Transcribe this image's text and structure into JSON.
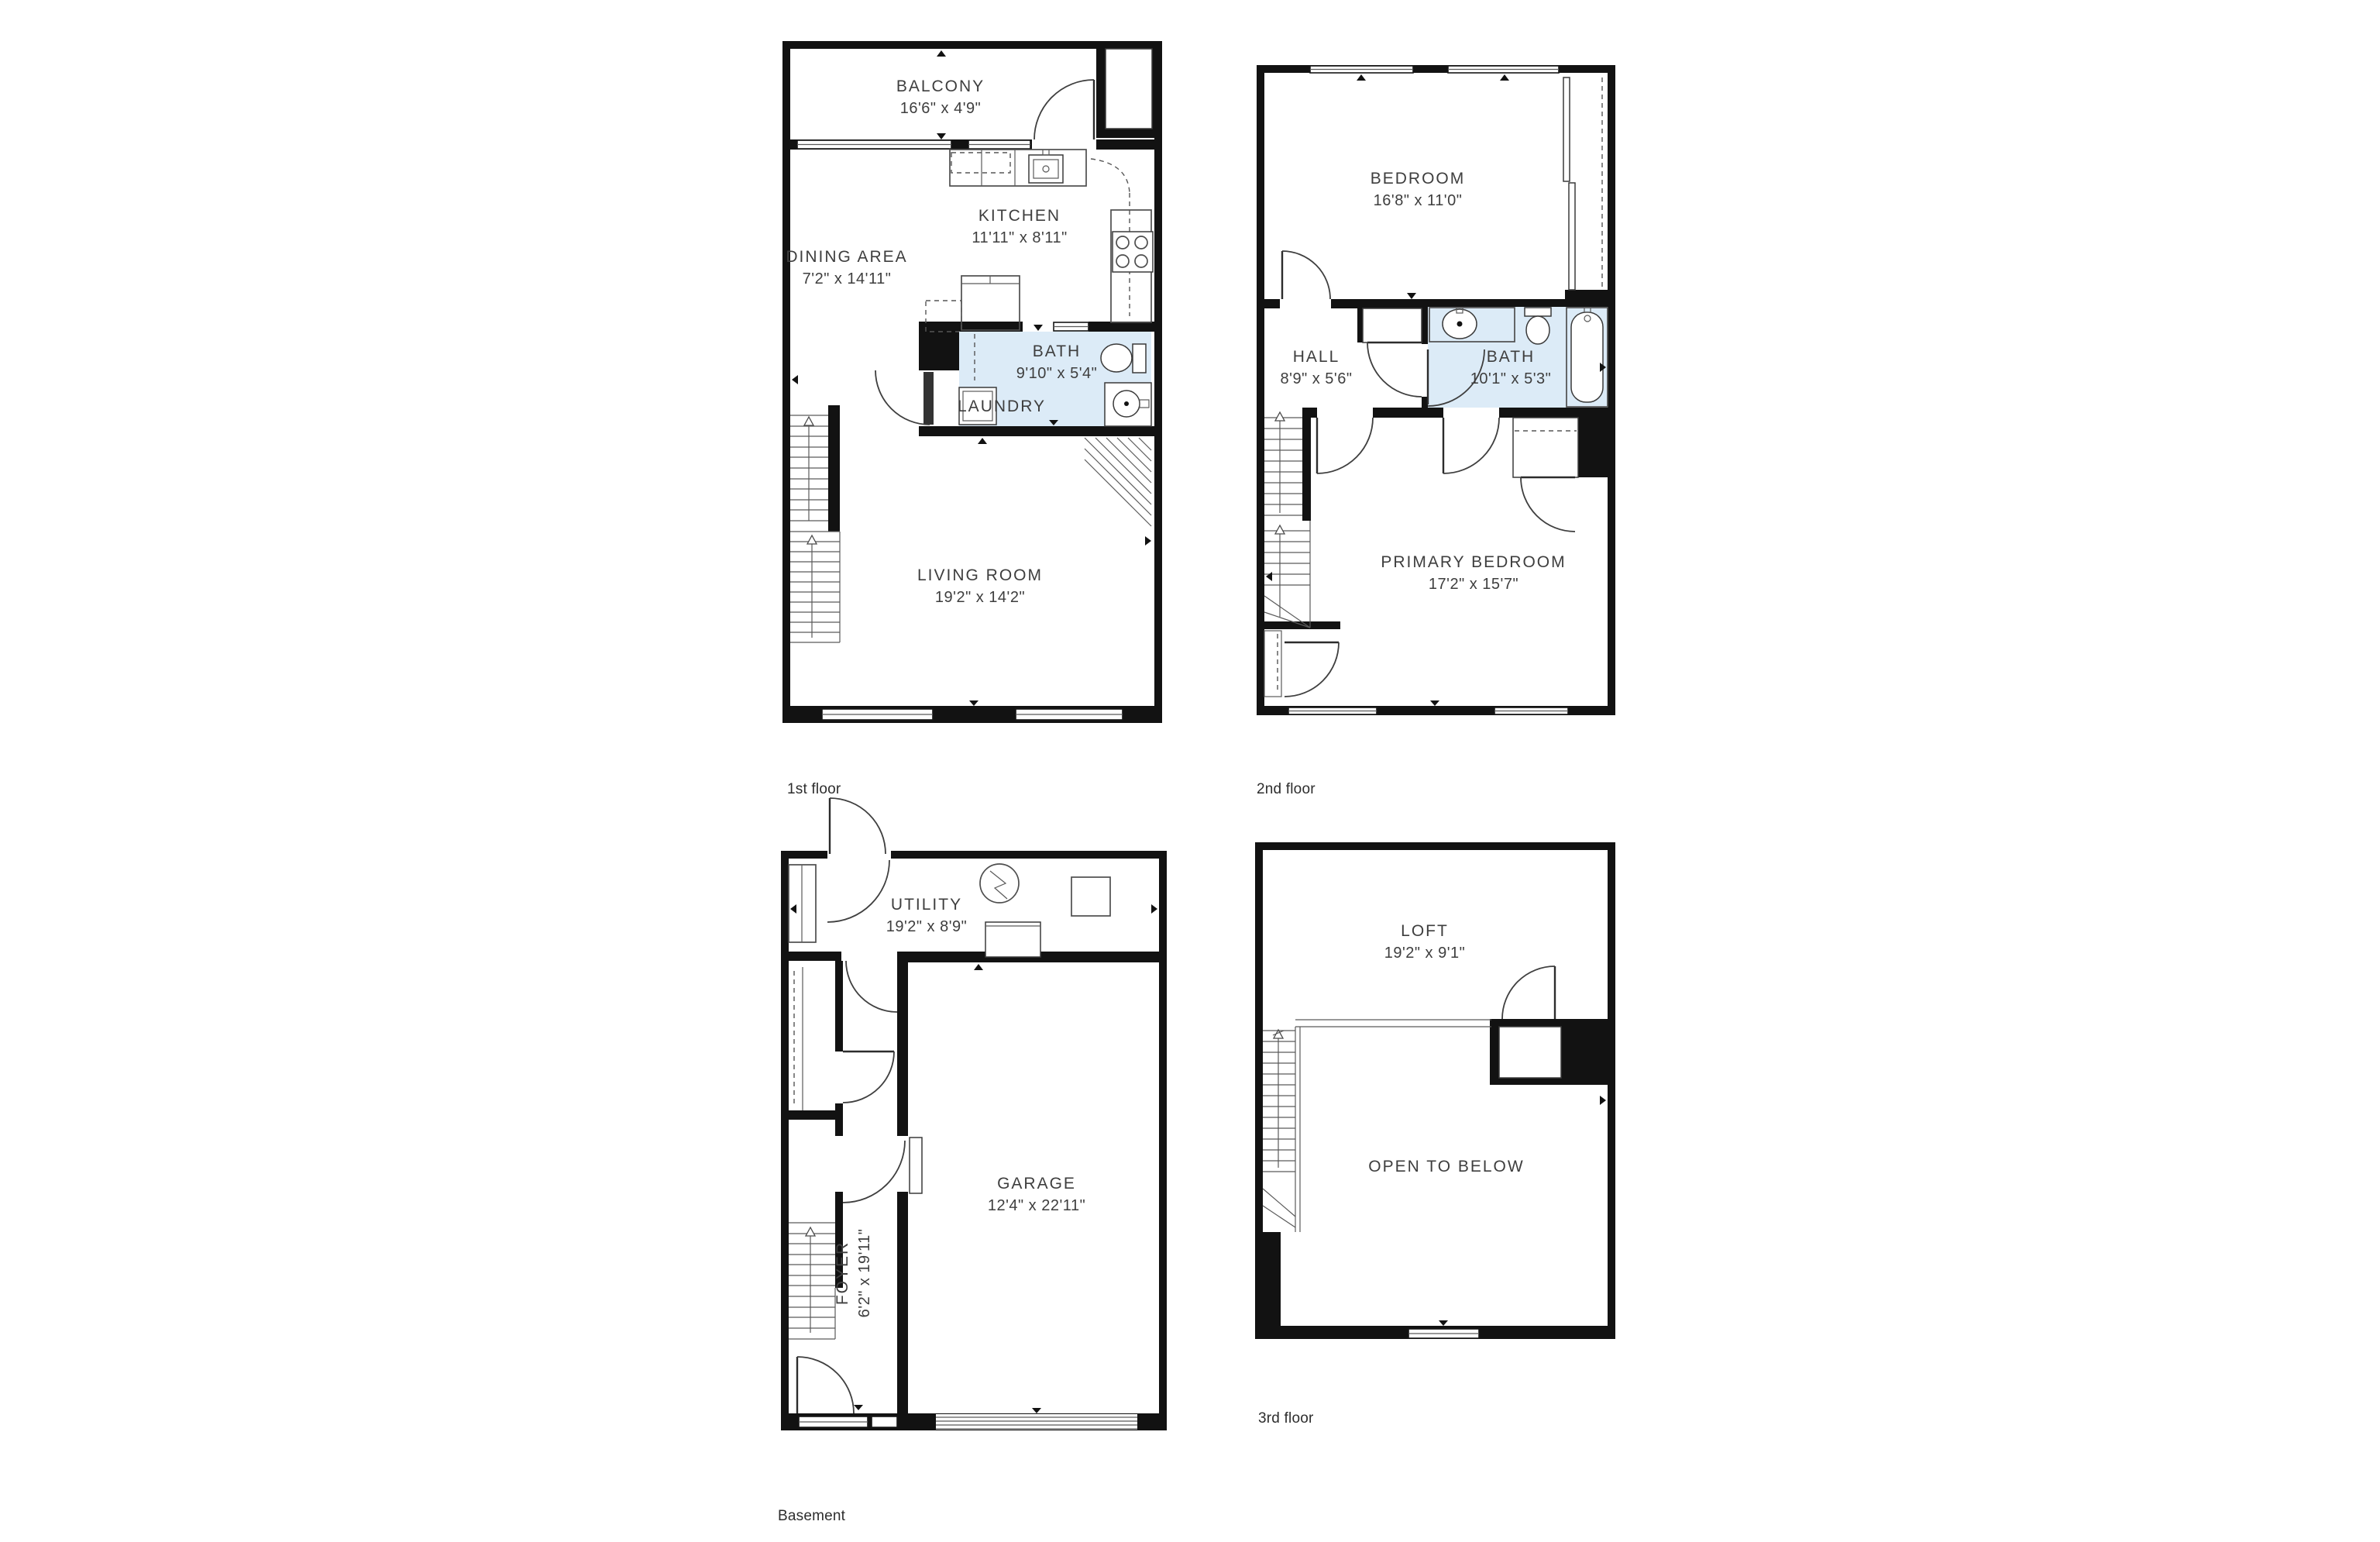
{
  "colors": {
    "wall": "#121212",
    "bath_fill": "#dcebf7",
    "fixture_line": "#4e4e4e",
    "text": "#3e3e3e"
  },
  "floors": {
    "floor1": {
      "label": "1st floor",
      "rooms": {
        "balcony": {
          "name": "BALCONY",
          "dims": "16'6\" x 4'9\""
        },
        "kitchen": {
          "name": "KITCHEN",
          "dims": "11'11\" x 8'11\""
        },
        "dining": {
          "name": "DINING AREA",
          "dims": "7'2\" x 14'11\""
        },
        "bath": {
          "name": "BATH",
          "dims": "9'10\" x 5'4\""
        },
        "laundry": {
          "name": "LAUNDRY"
        },
        "living": {
          "name": "LIVING ROOM",
          "dims": "19'2\" x 14'2\""
        }
      }
    },
    "floor2": {
      "label": "2nd floor",
      "rooms": {
        "bedroom": {
          "name": "BEDROOM",
          "dims": "16'8\" x 11'0\""
        },
        "hall": {
          "name": "HALL",
          "dims": "8'9\" x 5'6\""
        },
        "bath": {
          "name": "BATH",
          "dims": "10'1\" x 5'3\""
        },
        "primary": {
          "name": "PRIMARY BEDROOM",
          "dims": "17'2\" x 15'7\""
        }
      }
    },
    "basement": {
      "label": "Basement",
      "rooms": {
        "utility": {
          "name": "UTILITY",
          "dims": "19'2\" x 8'9\""
        },
        "garage": {
          "name": "GARAGE",
          "dims": "12'4\" x 22'11\""
        },
        "foyer": {
          "name": "FOYER",
          "dims": "6'2\" x 19'11\""
        }
      }
    },
    "floor3": {
      "label": "3rd floor",
      "rooms": {
        "loft": {
          "name": "LOFT",
          "dims": "19'2\" x 9'1\""
        },
        "open": {
          "name": "OPEN TO BELOW"
        }
      }
    }
  }
}
